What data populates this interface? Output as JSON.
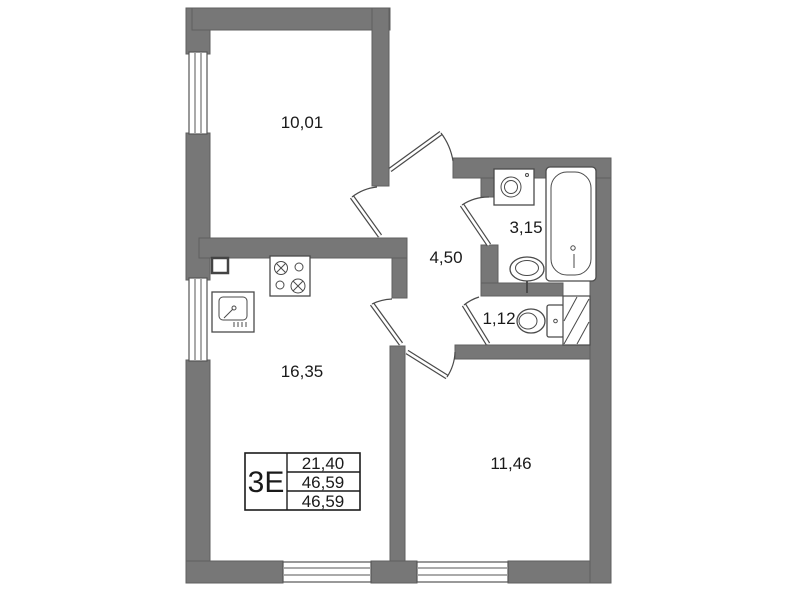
{
  "colors": {
    "wall": "#777777",
    "wall_edge": "#5f5f5f",
    "line": "#4a4a4a",
    "text": "#1a1a1a",
    "background": "#ffffff"
  },
  "rooms": {
    "room_top": {
      "area": "10,01"
    },
    "hallway": {
      "area": "4,50"
    },
    "bathroom": {
      "area": "3,15"
    },
    "wc": {
      "area": "1,12"
    },
    "kitchen_living": {
      "area": "16,35"
    },
    "room_right": {
      "area": "11,46"
    }
  },
  "spec_table": {
    "type_label": "3Е",
    "row1": "21,40",
    "row2": "46,59",
    "row3": "46,59"
  },
  "fixtures": [
    "four-burner-stove",
    "kitchen-sink",
    "washing-machine",
    "bathtub",
    "wash-basin",
    "toilet",
    "ventilation-shaft"
  ]
}
